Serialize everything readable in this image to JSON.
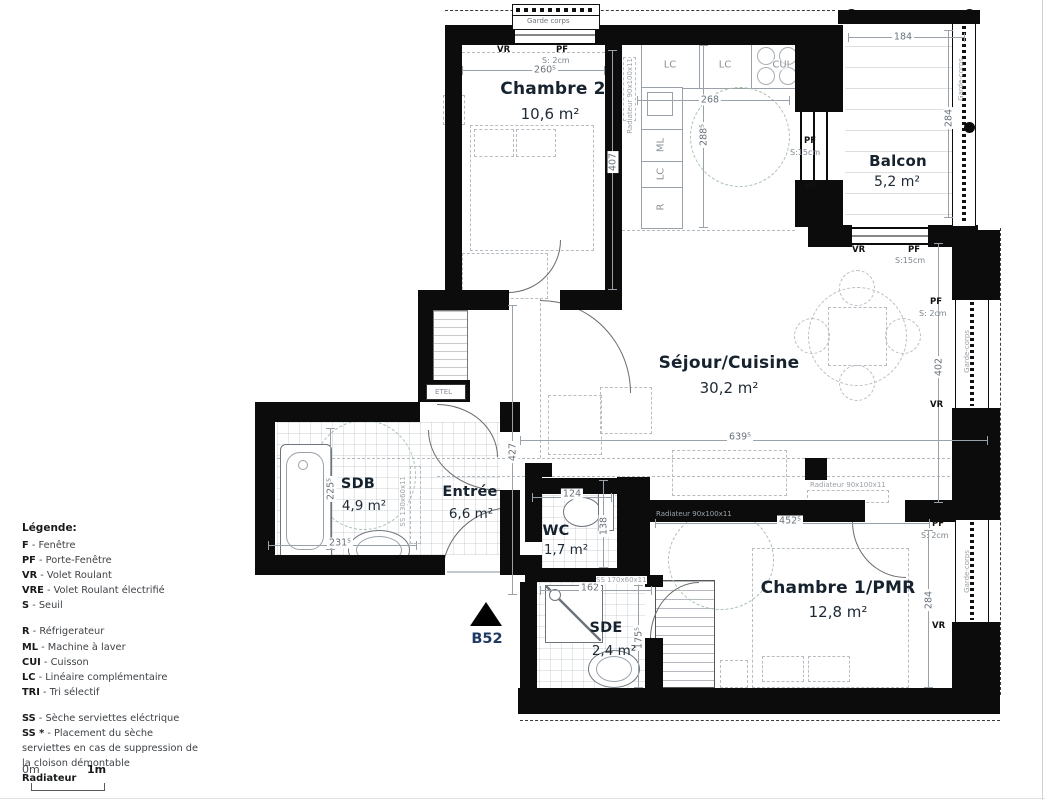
{
  "unit": {
    "label": "B52"
  },
  "rooms": {
    "chambre2": {
      "name": "Chambre 2",
      "area": "10,6 m²"
    },
    "balcon": {
      "name": "Balcon",
      "area": "5,2 m²"
    },
    "sejour": {
      "name": "Séjour/Cuisine",
      "area": "30,2 m²"
    },
    "chambre1": {
      "name": "Chambre 1/PMR",
      "area": "12,8 m²"
    },
    "sdb": {
      "name": "SDB",
      "area": "4,9 m²"
    },
    "entree": {
      "name": "Entrée",
      "area": "6,6 m²"
    },
    "wc": {
      "name": "WC",
      "area": "1,7 m²"
    },
    "sde": {
      "name": "SDE",
      "area": "2,4 m²"
    }
  },
  "dims": {
    "chambre2_w": "260⁵",
    "chambre2_h": "407",
    "kitchen_w": "268",
    "kitchen_h": "288⁵",
    "balcon_w": "184",
    "balcon_h": "284",
    "sejour_w": "639⁵",
    "sejour_h": "402",
    "entree_h": "427",
    "sdb_w": "231⁵",
    "sdb_h": "225⁵",
    "wc_w": "124",
    "wc_h": "138",
    "sde_w": "162",
    "sde_h": "175⁵",
    "chambre1_w": "452⁵",
    "chambre1_h": "284"
  },
  "openings": {
    "top_vr": "VR",
    "top_pf": "PF",
    "top_seuil": "S: 2cm",
    "kb_pf": "PF",
    "kb_seuil": "S:15cm",
    "kb_vr": "VR",
    "balc_vr": "VR",
    "balc_pf": "PF",
    "balc_seuil": "S:15cm",
    "sej_pf": "PF",
    "sej_seuil": "S: 2cm",
    "sej_vr": "VR",
    "ch1_pf": "PF",
    "ch1_seuil": "S: 2cm",
    "ch1_vr": "VR"
  },
  "kitchen": {
    "lc1": "LC",
    "lc2": "LC",
    "cui": "CUI",
    "ml": "ML",
    "lc3": "LC",
    "r": "R"
  },
  "annotations": {
    "garde_corps_top": "Garde corps",
    "garde_corps_balcon": "Garde-corps",
    "garde_corps_sejour": "Garde-corps",
    "garde_corps_ch1": "Garde-corps",
    "rad_chambre2": "Radiateur 90x100x11",
    "rad_sejour": "Radiateur 90x100x11",
    "rad_chambre1": "Radiateur 90x100x11",
    "ss_sdb": "SS 130x60x11",
    "ss_sde": "SS 170x60x11",
    "etel": "ETEL"
  },
  "legend": {
    "title": "Légende:",
    "items": [
      {
        "abbr": "F",
        "text": "- Fenêtre"
      },
      {
        "abbr": "PF",
        "text": "- Porte-Fenêtre"
      },
      {
        "abbr": "VR",
        "text": "- Volet Roulant"
      },
      {
        "abbr": "VRE",
        "text": "- Volet Roulant électrifié"
      },
      {
        "abbr": "S",
        "text": "- Seuil"
      },
      {
        "abbr": "R",
        "text": "- Réfrigerateur"
      },
      {
        "abbr": "ML",
        "text": "- Machine à laver"
      },
      {
        "abbr": "CUI",
        "text": "- Cuisson"
      },
      {
        "abbr": "LC",
        "text": "- Linéaire complémentaire"
      },
      {
        "abbr": "TRI",
        "text": "- Tri sélectif"
      },
      {
        "abbr": "SS",
        "text": "- Sèche serviettes eléctrique"
      }
    ],
    "ss_star_abbr": "SS *",
    "ss_star_line1": "- Placement du sèche",
    "ss_star_line2": "serviettes en cas de suppression de",
    "ss_star_line3": "la cloison démontable",
    "radiateur": "Radiateur"
  },
  "scale": {
    "zero": "0m",
    "one": "1m"
  }
}
